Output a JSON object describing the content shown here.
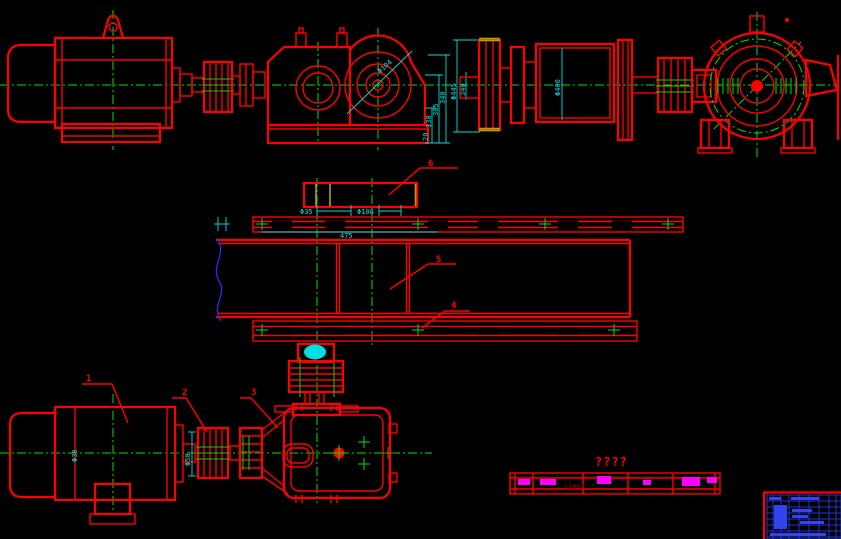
{
  "canvas": {
    "width": 841,
    "height": 539,
    "background": "#000000"
  },
  "palette": {
    "geometry": "#ff0000",
    "centerline": "#00e000",
    "dimension": "#00e0e0",
    "break_line": "#2b2bdf",
    "highlight": "#ff00ff",
    "accent": "#b8a000",
    "title_block": "#2233cc",
    "cyan_fill": "#00e0e0"
  },
  "callouts": {
    "item1": "1",
    "item2": "2",
    "item3": "3",
    "item4": "4",
    "item5": "5",
    "item6": "6"
  },
  "dimensions": {
    "reducer_bore": "Φ104",
    "reducer_heights": [
      "340",
      "305",
      "130",
      "20"
    ],
    "drum_flange_dia": "Φ445",
    "drum_width": "340",
    "drum_dia": "Φ400",
    "hub_dia": "Φ35",
    "shaft_dia": "Φ100",
    "pulley_length": "475",
    "coupling_dia": "Φ50",
    "motor_shaft_dia": "Φ38"
  },
  "annotations": {
    "missing_text": "????",
    "strip_dim": "(100)"
  }
}
